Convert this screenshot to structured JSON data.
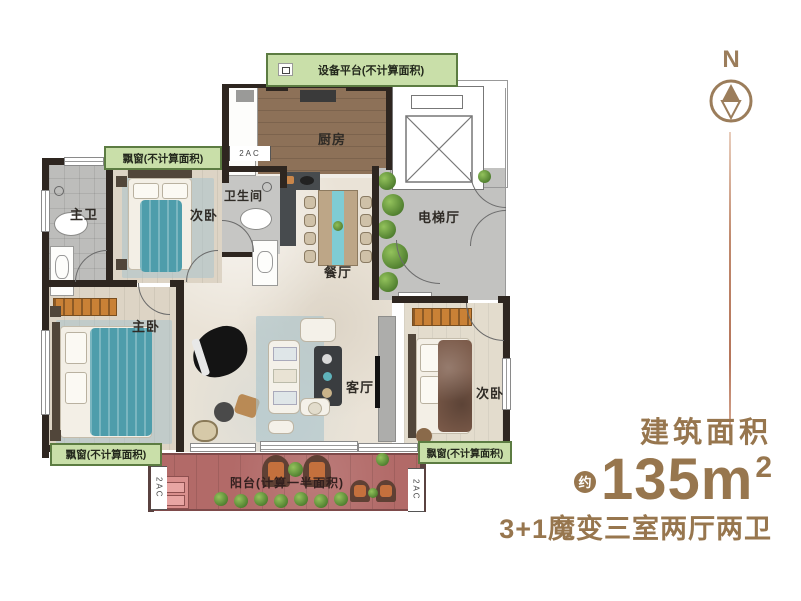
{
  "plan": {
    "labels": {
      "equipment_platform": "设备平台(不计算面积)",
      "bay_window": "飘窗(不计算面积)",
      "kitchen": "厨房",
      "master_bath": "主卫",
      "bedroom_second_top": "次卧",
      "bathroom": "卫生间",
      "dining": "餐厅",
      "elevator_hall": "电梯厅",
      "master_bedroom": "主卧",
      "living": "客厅",
      "bedroom_second_right": "次卧",
      "balcony": "阳台(计算一半面积)",
      "ac_marker": "2AC"
    }
  },
  "legend": {
    "north": "N",
    "area_title": "建筑面积",
    "approx": "约",
    "area_value": "135m",
    "area_sup": "2",
    "tagline": "3+1魔变三室两厅两卫"
  },
  "colors": {
    "accent_brown": "#97764e",
    "band_green": "#c9dfa9",
    "band_border": "#5c7c42",
    "balcony_floor": "#b26a68",
    "teal_furniture": "#4e9dab",
    "wall": "#2e2620"
  }
}
